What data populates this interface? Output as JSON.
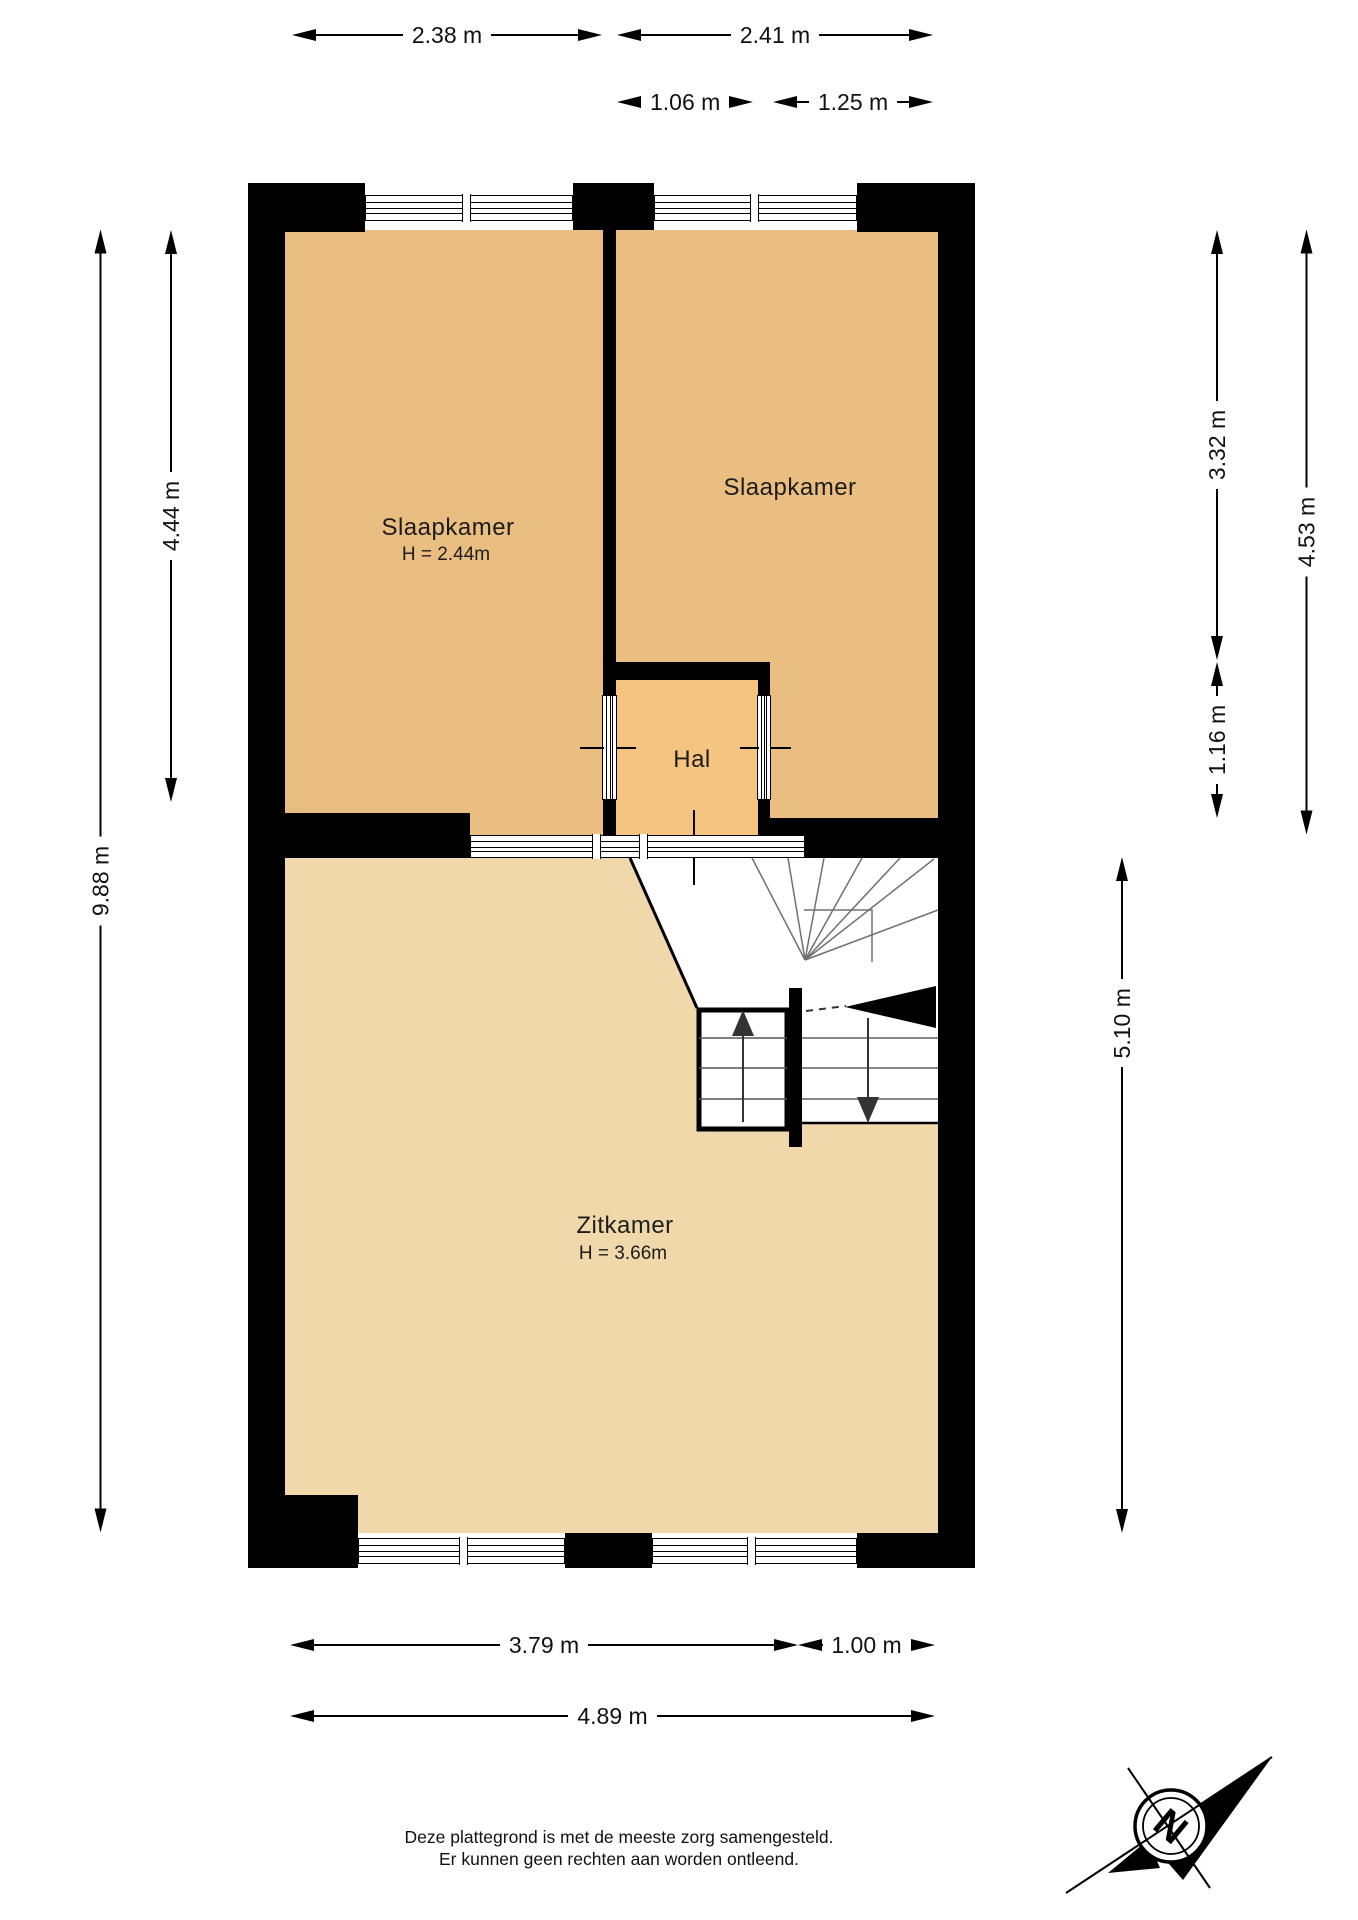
{
  "title": "Floor plan (plattegrond)",
  "rooms": {
    "bedroom1": {
      "label": "Slaapkamer",
      "height": "H = 2.44m"
    },
    "bedroom2": {
      "label": "Slaapkamer"
    },
    "hall": {
      "label": "Hal"
    },
    "living": {
      "label": "Zitkamer",
      "height": "H = 3.66m"
    }
  },
  "dimensions": {
    "top": {
      "bedroom1_width": "2.38 m",
      "bedroom2_width": "2.41 m",
      "window_left": "1.06 m",
      "window_right": "1.25 m"
    },
    "left": {
      "bedroom1_depth": "4.44 m",
      "total_depth": "9.88 m"
    },
    "right": {
      "bedroom2_depth": "3.32 m",
      "hall_depth": "1.16 m",
      "bedroom2_total_depth": "4.53 m",
      "living_depth": "5.10 m"
    },
    "bottom": {
      "living_window_width": "3.79 m",
      "door_width": "1.00 m",
      "total_width": "4.89 m"
    }
  },
  "compass": {
    "north_label": "N"
  },
  "footer": {
    "line1": "Deze plattegrond is met de meeste zorg samengesteld.",
    "line2": "Er kunnen geen rechten aan worden ontleend."
  },
  "colors": {
    "wall": "#000000",
    "bedroom_fill": "#eabd81",
    "hall_fill": "#f6c481",
    "living_fill": "#f1d8ab"
  }
}
